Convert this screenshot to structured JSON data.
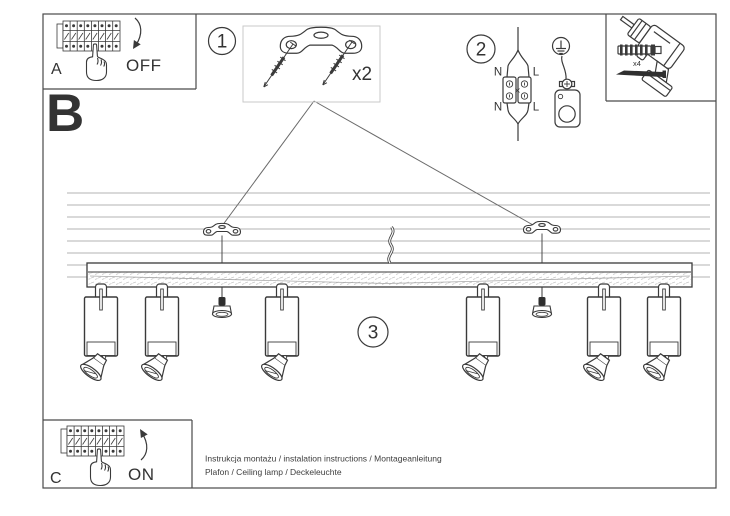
{
  "document": {
    "footer_line1": "Instrukcja montażu / instalation instructions / Montageanleitung",
    "footer_line2": "Plafon / Ceiling lamp / Deckeleuchte"
  },
  "sections": {
    "a": {
      "label": "A",
      "state": "OFF"
    },
    "b": {
      "label": "B"
    },
    "c": {
      "label": "C",
      "state": "ON"
    }
  },
  "steps": {
    "step1": {
      "number": "1",
      "quantity": "x2"
    },
    "step2": {
      "number": "2",
      "wire_top_left": "N",
      "wire_top_right": "L",
      "wire_bottom_left": "N",
      "wire_bottom_right": "L"
    },
    "step3": {
      "number": "3"
    }
  },
  "tools": {
    "anchor_quantity": "x4"
  },
  "colors": {
    "ink": "#3a3a3a",
    "ceiling_line": "#b3b3b3",
    "background": "#ffffff"
  }
}
